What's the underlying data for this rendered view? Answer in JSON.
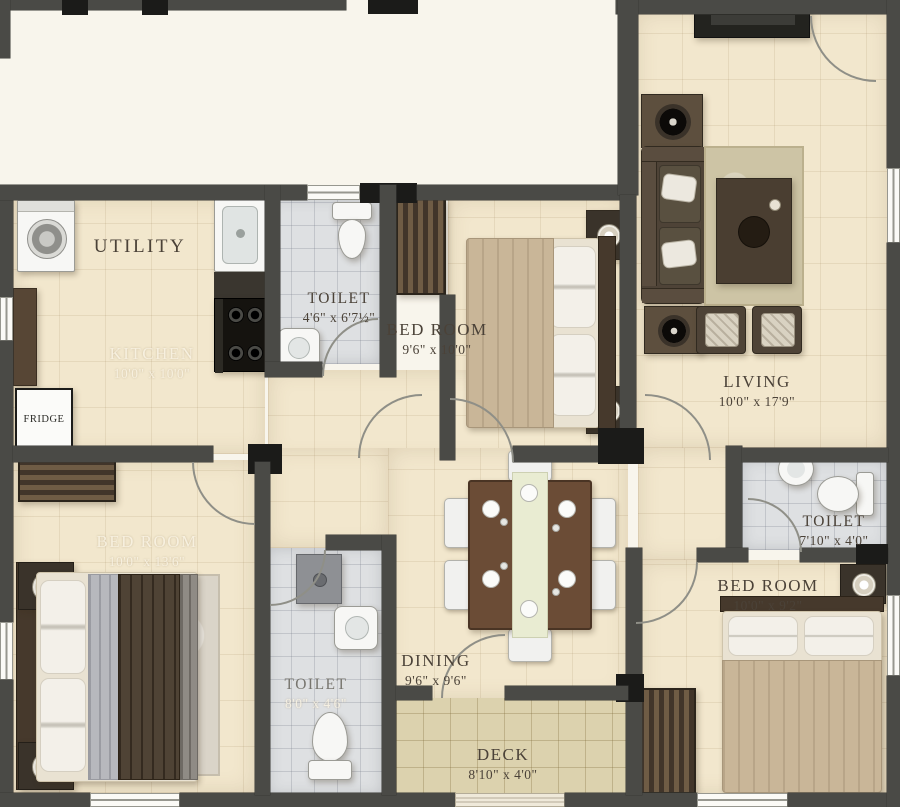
{
  "rooms": {
    "utility": {
      "name": "UTILITY",
      "dims": ""
    },
    "kitchen": {
      "name": "KITCHEN",
      "dims": "10'0\" x 10'0\""
    },
    "toilet_top": {
      "name": "TOILET",
      "dims": "4'6\" x 6'7½\""
    },
    "bedroom_top": {
      "name": "BED ROOM",
      "dims": "9'6\" x 10'0\""
    },
    "living": {
      "name": "LIVING",
      "dims": "10'0\" x 17'9\""
    },
    "bedroom_left": {
      "name": "BED ROOM",
      "dims": "10'0\" x 13'6\""
    },
    "dining": {
      "name": "DINING",
      "dims": "9'6\" x 9'6\""
    },
    "toilet_bottom": {
      "name": "TOILET",
      "dims": "8'0\" x 4'6\""
    },
    "toilet_right": {
      "name": "TOILET",
      "dims": "7'10\" x 4'0\""
    },
    "bedroom_right": {
      "name": "BED ROOM",
      "dims": "10'0\" x 9'2\""
    },
    "deck": {
      "name": "DECK",
      "dims": "8'10\" x 4'0\""
    }
  },
  "appliances": {
    "fridge": "FRIDGE"
  },
  "palette": {
    "wall": "#4a4a46",
    "pillar": "#1b1b19",
    "floor_beige": "#f2e7cd",
    "floor_bath": "#dee0e2",
    "floor_deck": "#dcd2ae",
    "wood_dark": "#4e4337",
    "fabric_tan": "#c9b698",
    "exterior": "#f8f5ec"
  }
}
